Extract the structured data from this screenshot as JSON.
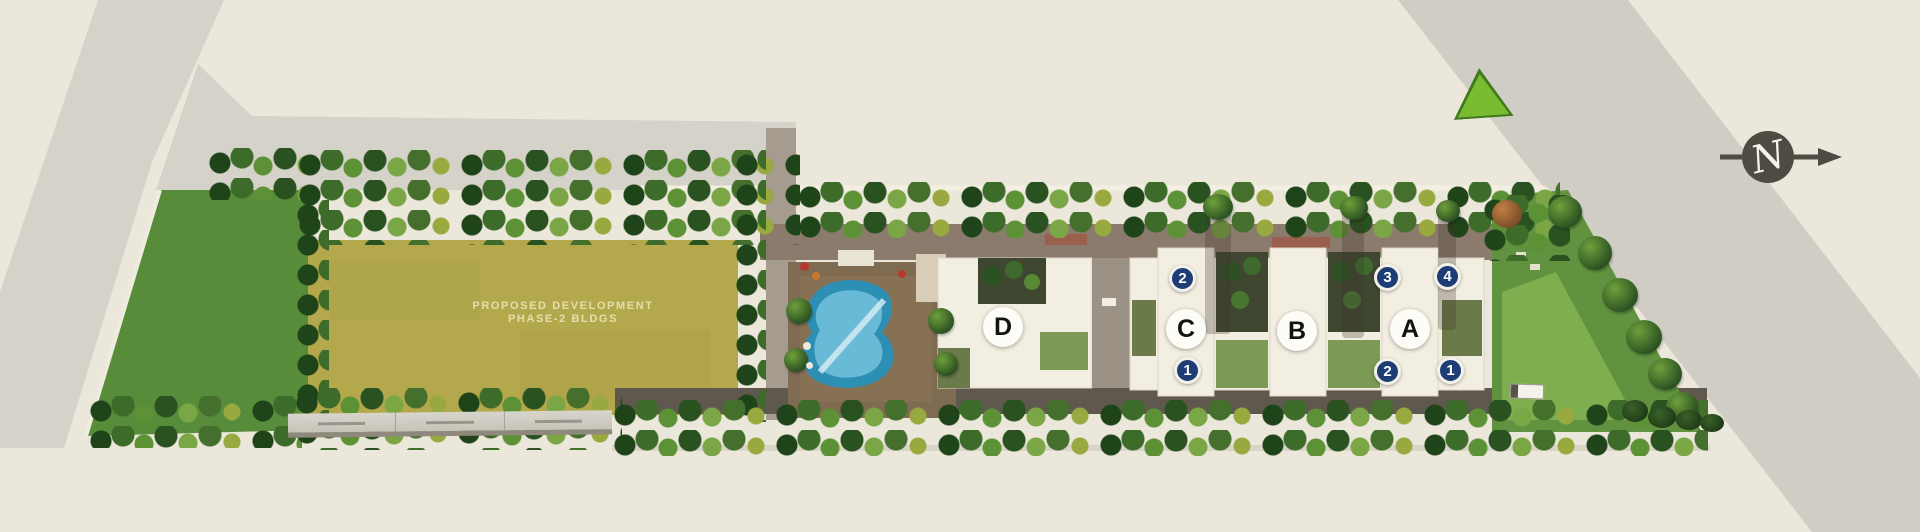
{
  "plan": {
    "phase2_plot": {
      "label_line1": "PROPOSED DEVELOPMENT",
      "label_line2": "PHASE-2 BLDGS"
    },
    "blocks": [
      {
        "label": "D"
      },
      {
        "label": "C"
      },
      {
        "label": "B"
      },
      {
        "label": "A"
      }
    ],
    "unit_markers": [
      {
        "label": "2",
        "position": "top-of-C"
      },
      {
        "label": "3",
        "position": "top-left-of-A"
      },
      {
        "label": "4",
        "position": "top-right-of-A"
      },
      {
        "label": "1",
        "position": "bottom-of-C"
      },
      {
        "label": "2",
        "position": "bottom-left-of-A"
      },
      {
        "label": "1",
        "position": "bottom-right-of-A"
      }
    ],
    "compass": {
      "label": "N",
      "direction": "east-pointing-arrow"
    },
    "colors": {
      "background": "#ebe7da",
      "road": "#d5d2ca",
      "lawn": "#578c3a",
      "phase2_plot": "#b3a84c",
      "building": "#f2eee1",
      "pool": "#2e8fb4",
      "marker_navy": "#1d3d74",
      "triangle_green": "#79bb31"
    }
  }
}
